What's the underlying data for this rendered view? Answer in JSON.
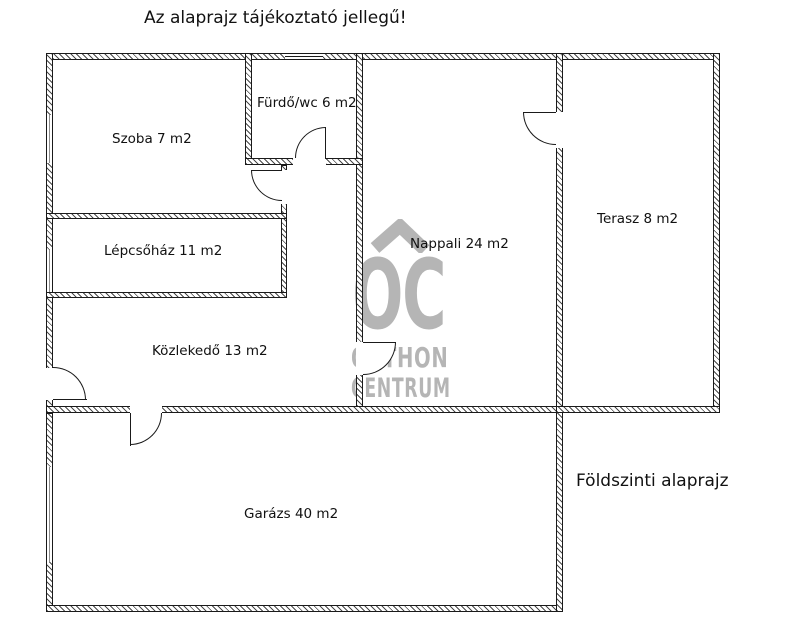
{
  "title": "Az alaprajz tájékoztató jellegű!",
  "plan_label": "Földszinti alaprajz",
  "rooms": [
    {
      "name": "Szoba",
      "area_m2": 7,
      "label": "Szoba 7 m2"
    },
    {
      "name": "Fürdő/wc",
      "area_m2": 6,
      "label": "Fürdő/wc 6 m2"
    },
    {
      "name": "Nappali",
      "area_m2": 24,
      "label": "Nappali 24 m2"
    },
    {
      "name": "Terasz",
      "area_m2": 8,
      "label": "Terasz 8 m2"
    },
    {
      "name": "Lépcsőház",
      "area_m2": 11,
      "label": "Lépcsőház 11 m2"
    },
    {
      "name": "Közlekedő",
      "area_m2": 13,
      "label": "Közlekedő 13 m2"
    },
    {
      "name": "Garázs",
      "area_m2": 40,
      "label": "Garázs 40 m2"
    }
  ],
  "watermark": {
    "monogram": "OC",
    "line1": "OTTHON",
    "line2": "CENTRUM",
    "icon": "house-roof-icon",
    "color": "#b5b5b5"
  },
  "colors": {
    "line": "#1a1a1a",
    "background": "#ffffff"
  }
}
